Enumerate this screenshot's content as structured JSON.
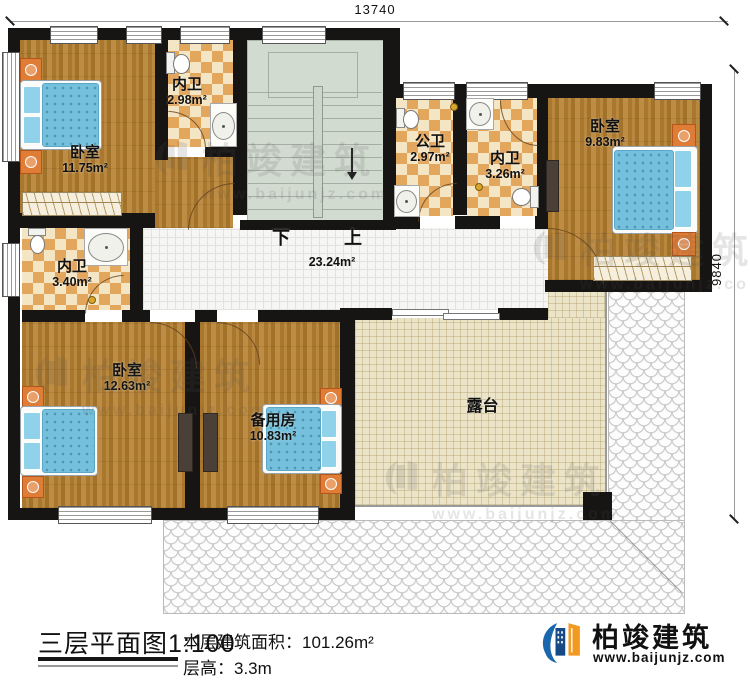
{
  "dimensions": {
    "width_top": "13740",
    "height_right": "9840"
  },
  "rooms": {
    "bedroom_tl": {
      "name": "卧室",
      "area": "11.75m²"
    },
    "bath_tl": {
      "name": "内卫",
      "area": "2.98m²"
    },
    "bath_public": {
      "name": "公卫",
      "area": "2.97m²"
    },
    "bath_tr": {
      "name": "内卫",
      "area": "3.26m²"
    },
    "bedroom_tr": {
      "name": "卧室",
      "area": "9.83m²"
    },
    "bath_ml": {
      "name": "内卫",
      "area": "3.40m²"
    },
    "hall": {
      "area": "23.24m²",
      "label_down": "下",
      "label_up": "上"
    },
    "bedroom_bl": {
      "name": "卧室",
      "area": "12.63m²"
    },
    "spare_room": {
      "name": "备用房",
      "area": "10.83m²"
    },
    "terrace": {
      "name": "露台"
    }
  },
  "footer": {
    "title": "三层平面图1:100",
    "area_label": "本层建筑面积：",
    "area_value": "101.26m²",
    "floor_height_label": "层高：",
    "floor_height_value": "3.3m"
  },
  "brand": {
    "name": "柏竣建筑",
    "website": "www.baijunjz.com",
    "blue": "#1b67ad",
    "navy": "#164a86",
    "orange": "#f2991f"
  }
}
